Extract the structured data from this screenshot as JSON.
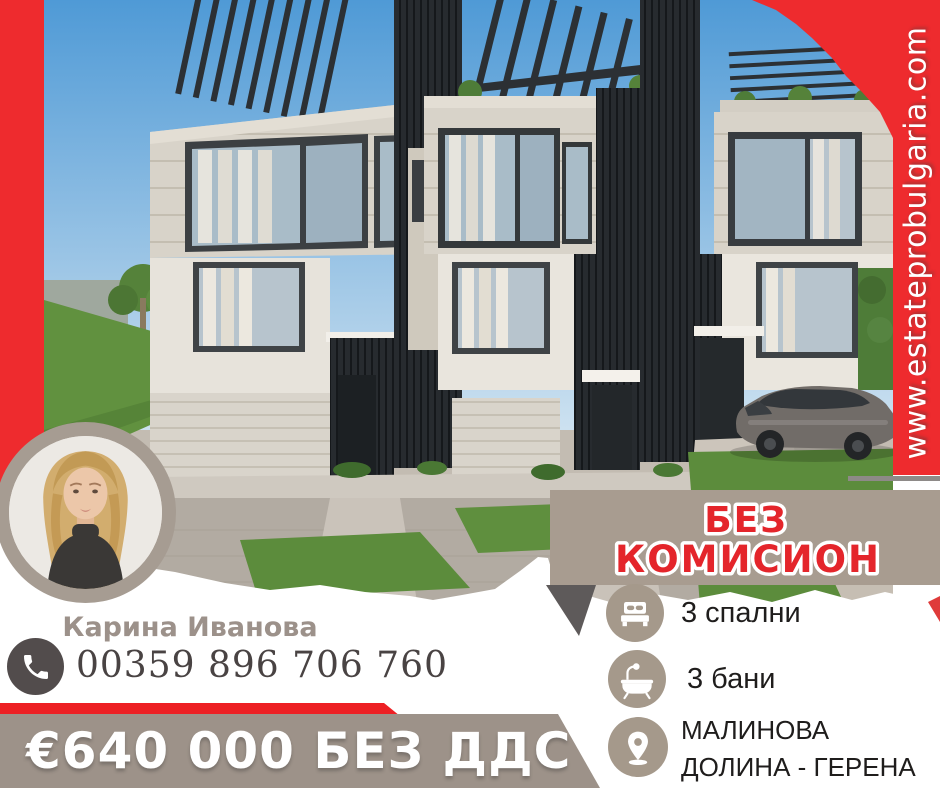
{
  "website": {
    "url": "www.estateprobulgaria.com"
  },
  "agent": {
    "name": "Карина Иванова",
    "phone": "00359 896 706 760"
  },
  "price": {
    "label": "€640 000 БЕЗ ДДС"
  },
  "no_commission": {
    "line1": "БЕЗ",
    "line2": "КОМИСИОН"
  },
  "features": [
    {
      "icon": "bed-icon",
      "label": "3 спални"
    },
    {
      "icon": "bathtub-icon",
      "label": "3 бани"
    },
    {
      "icon": "location-pin-icon",
      "label": "МАЛИНОВА ДОЛИНА - ГЕРЕНА"
    }
  ],
  "colors": {
    "brand_red": "#ee2b2e",
    "taupe_banner": "#a89c90",
    "taupe_price": "#9d9289",
    "dark_gray": "#524c4c",
    "name_gray": "#9c918a",
    "accent_text_red": "#e4252b"
  }
}
